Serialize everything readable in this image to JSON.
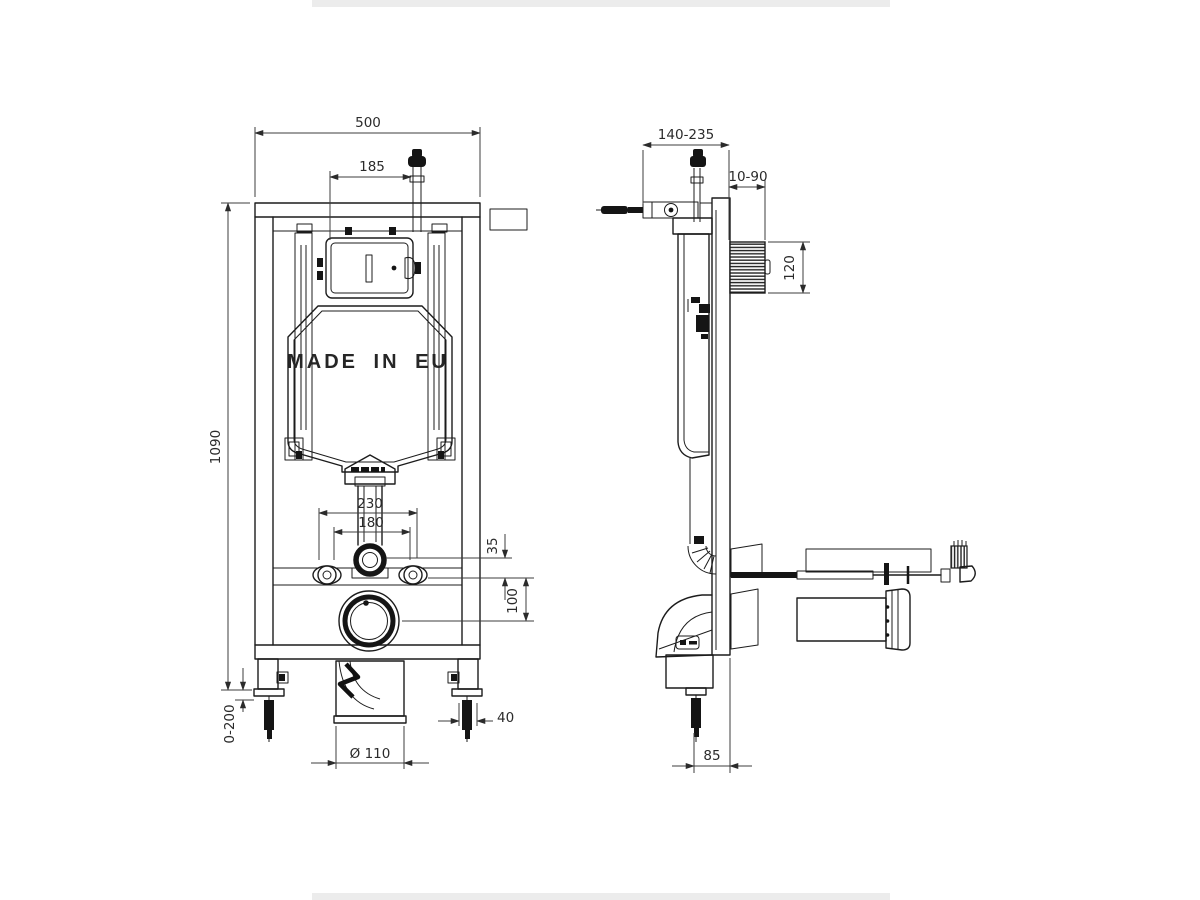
{
  "labels": {
    "made_in": "MADE IN EU"
  },
  "front_view": {
    "dims": {
      "frame_width": "500",
      "plate_offset": "185",
      "frame_height": "1090",
      "fixing_outer": "230",
      "fixing_inner": "180",
      "flush_offset": "35",
      "drain_offset": "100",
      "foot_adjust": "0-200",
      "foot_size": "40",
      "drain_dia": "Ø 110"
    }
  },
  "side_view": {
    "dims": {
      "depth_range": "140-235",
      "wall_range": "10-90",
      "access_height": "120",
      "foot_to_wall": "85"
    }
  }
}
